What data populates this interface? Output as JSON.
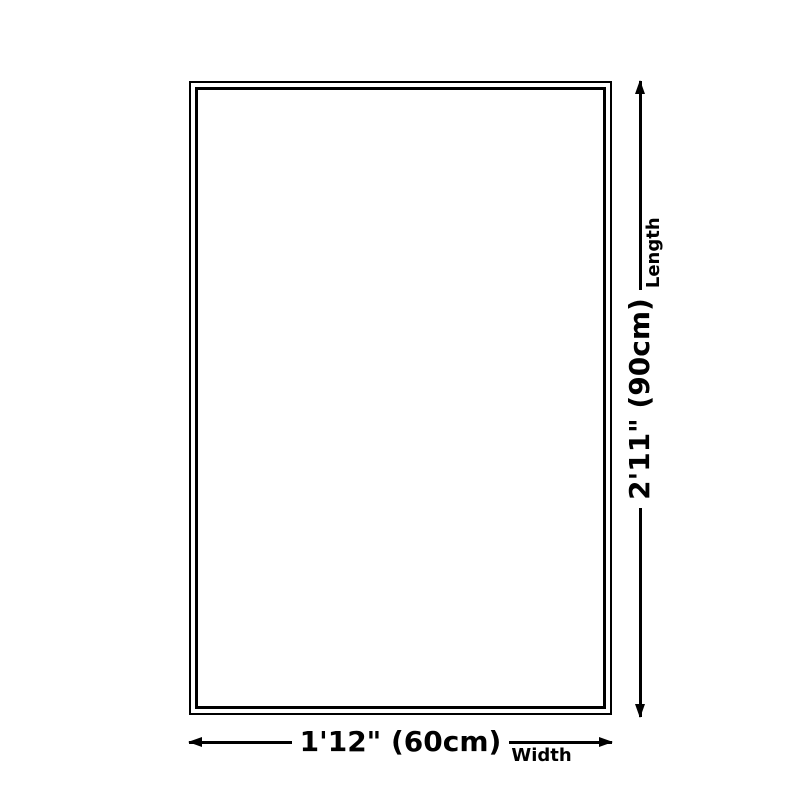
{
  "diagram": {
    "width": {
      "value": "1'12\" (60cm)",
      "label": "Width"
    },
    "length": {
      "value": "2'11\" (90cm)",
      "label": "Length"
    },
    "colors": {
      "ink": "#000000",
      "background": "#ffffff"
    }
  }
}
